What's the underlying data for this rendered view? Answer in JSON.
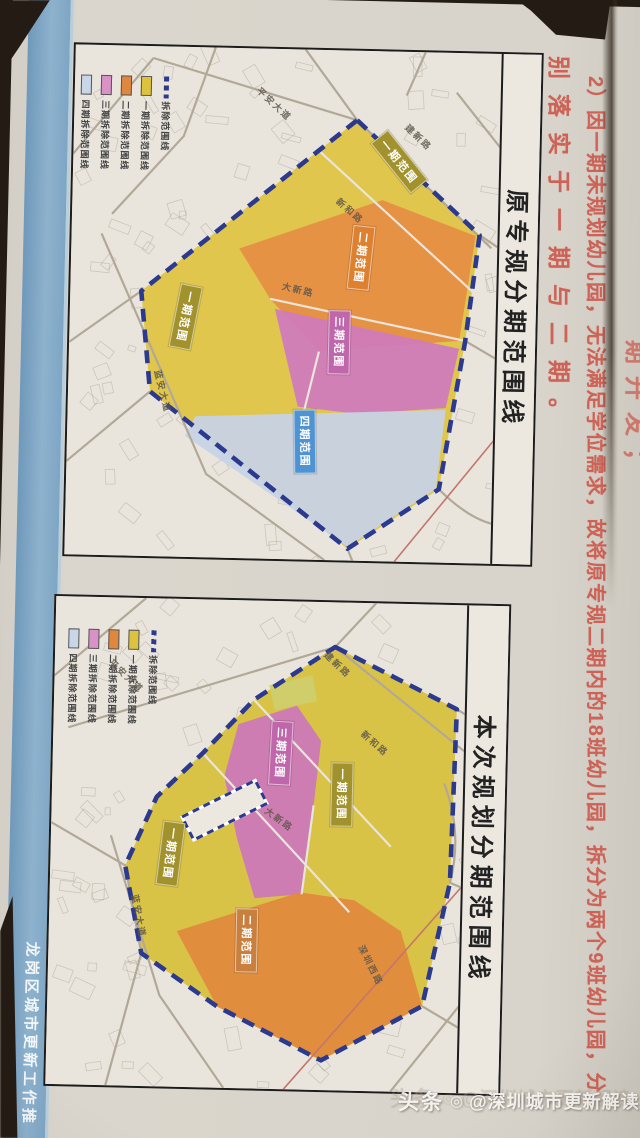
{
  "photo": {
    "table_color": "#241c14",
    "paper_color": "#d8d4cb"
  },
  "side_strip": {
    "color": "#84abc8",
    "label": "龙岗区城市更新工作推"
  },
  "annotations": {
    "color": "#cd5a4e",
    "partial_line": "期开发；",
    "line1": "2）因一期未规划幼儿园，无法满足学位需求，故将原专规二期内的18班幼儿园，拆分为两个9班幼儿园，分",
    "line2": "别落实于一期与二期。"
  },
  "watermark": {
    "brand": "头条",
    "logo_glyph": "◎",
    "handle": "@深圳城市更新解读"
  },
  "legend_items": [
    {
      "label": "四期拆除范围线",
      "color": "#c9d6e8",
      "kind": "swatch"
    },
    {
      "label": "三期拆除范围线",
      "color": "#d892c6",
      "kind": "swatch"
    },
    {
      "label": "二期拆除范围线",
      "color": "#e0873f",
      "kind": "swatch"
    },
    {
      "label": "一期拆除范围线",
      "color": "#ddc23f",
      "kind": "swatch"
    },
    {
      "label": "拆除范围线",
      "color": "#2b3a8e",
      "kind": "dash"
    }
  ],
  "maps": [
    {
      "title": "原专规分期范围线",
      "frame": {
        "left": 62,
        "top": 48,
        "width": 470,
        "height": 514,
        "band": 40
      },
      "legend_pos": {
        "x": 6,
        "y": 30
      },
      "outline": {
        "color": "#2b3a8e",
        "points": [
          [
            283,
            70
          ],
          [
            408,
            183
          ],
          [
            396,
            290
          ],
          [
            373,
            440
          ],
          [
            283,
            502
          ],
          [
            82,
            348
          ],
          [
            71,
            247
          ]
        ]
      },
      "regions": [
        {
          "name": "phase1-area",
          "color": "#e0c445",
          "points": [
            [
              283,
              70
            ],
            [
              408,
              183
            ],
            [
              396,
              290
            ],
            [
              373,
              440
            ],
            [
              283,
              502
            ],
            [
              82,
              348
            ],
            [
              71,
              247
            ]
          ]
        },
        {
          "name": "phase2-area",
          "color": "#e68f44",
          "points": [
            [
              168,
              202
            ],
            [
              310,
              150
            ],
            [
              404,
              184
            ],
            [
              390,
              290
            ],
            [
              250,
              304
            ],
            [
              200,
              252
            ]
          ]
        },
        {
          "name": "phase3-area",
          "color": "#d07cba",
          "points": [
            [
              205,
              262
            ],
            [
              390,
              298
            ],
            [
              378,
              358
            ],
            [
              290,
              366
            ],
            [
              230,
              360
            ]
          ]
        },
        {
          "name": "phase4-area",
          "color": "#c7d3e4",
          "points": [
            [
              128,
              372
            ],
            [
              378,
              360
            ],
            [
              370,
              440
            ],
            [
              283,
              500
            ],
            [
              118,
              392
            ]
          ]
        }
      ],
      "roads": [
        {
          "d": "M78,12 L283,70 L420,196"
        },
        {
          "d": "M0,110 L78,12"
        },
        {
          "d": "M140,0 L110,90 L40,170"
        },
        {
          "d": "M230,0 L283,70"
        },
        {
          "d": "M0,300 L71,247"
        },
        {
          "d": "M0,420 L82,348"
        },
        {
          "d": "M30,190 L140,430 L260,514"
        },
        {
          "d": "M247,103 L402,240",
          "light": true
        },
        {
          "d": "M200,252 L396,290",
          "light": true
        },
        {
          "d": "M250,304 L236,366",
          "light": true
        },
        {
          "d": "M373,440 Q402,468 428,474"
        },
        {
          "d": "M283,502 L288,514"
        },
        {
          "d": "M330,514 L428,388",
          "red": true
        },
        {
          "d": "M396,290 L428,308"
        },
        {
          "d": "M408,183 L428,196"
        },
        {
          "d": "M350,0 L332,44"
        },
        {
          "d": "M428,96 L382,40"
        }
      ],
      "badges": [
        {
          "label": "一期范围",
          "color": "#a2922e",
          "x": 326,
          "y": 110,
          "rot": 50
        },
        {
          "label": "二期范围",
          "color": "#dd8030",
          "x": 290,
          "y": 207,
          "rot": 95
        },
        {
          "label": "三期范围",
          "color": "#c066ab",
          "x": 270,
          "y": 292,
          "rot": 90
        },
        {
          "label": "一期范围",
          "color": "#a2922e",
          "x": 116,
          "y": 270,
          "rot": 100
        },
        {
          "label": "四期范围",
          "color": "#4f93d2",
          "x": 238,
          "y": 392,
          "rot": 88
        }
      ],
      "road_labels": [
        {
          "label": "平安大道",
          "x": 200,
          "y": 55,
          "rot": 42
        },
        {
          "label": "建新路",
          "x": 345,
          "y": 85,
          "rot": 42
        },
        {
          "label": "新和路",
          "x": 278,
          "y": 160,
          "rot": 40
        },
        {
          "label": "大新路",
          "x": 228,
          "y": 240,
          "rot": 12
        },
        {
          "label": "蓝安大道",
          "x": 95,
          "y": 345,
          "rot": 75
        }
      ]
    },
    {
      "title": "本次规划分期范围线",
      "frame": {
        "left": 55,
        "top": 600,
        "width": 457,
        "height": 492,
        "band": 42
      },
      "legend_pos": {
        "x": 13,
        "y": 32
      },
      "outline": {
        "color": "#2b3a8e",
        "points": [
          [
            280,
            45
          ],
          [
            403,
            105
          ],
          [
            400,
            280
          ],
          [
            375,
            405
          ],
          [
            275,
            462
          ],
          [
            170,
            410
          ],
          [
            93,
            358
          ],
          [
            75,
            270
          ],
          [
            105,
            200
          ],
          [
            150,
            155
          ],
          [
            200,
            100
          ]
        ]
      },
      "regions": [
        {
          "name": "phase1-area",
          "color": "#d8c13e",
          "points": [
            [
              280,
              45
            ],
            [
              403,
              105
            ],
            [
              400,
              280
            ],
            [
              375,
              405
            ],
            [
              275,
              462
            ],
            [
              170,
              410
            ],
            [
              93,
              358
            ],
            [
              75,
              270
            ],
            [
              105,
              200
            ],
            [
              150,
              155
            ],
            [
              200,
              100
            ]
          ]
        },
        {
          "name": "park-area",
          "color": "#cfcf6d",
          "points": [
            [
              215,
              85
            ],
            [
              258,
              74
            ],
            [
              263,
              100
            ],
            [
              221,
              110
            ]
          ]
        },
        {
          "name": "phase3-area",
          "color": "#cc79b7",
          "points": [
            [
              185,
              125
            ],
            [
              243,
              105
            ],
            [
              268,
              140
            ],
            [
              262,
              205
            ],
            [
              252,
              295
            ],
            [
              205,
              300
            ],
            [
              186,
              240
            ],
            [
              172,
              178
            ]
          ]
        },
        {
          "name": "phase2-area",
          "color": "#e28a3e",
          "points": [
            [
              128,
              335
            ],
            [
              250,
              293
            ],
            [
              305,
              300
            ],
            [
              352,
              330
            ],
            [
              375,
              405
            ],
            [
              275,
              462
            ],
            [
              170,
              410
            ]
          ]
        }
      ],
      "dashed_rect": {
        "x": 173,
        "y": 212,
        "w": 82,
        "h": 26,
        "rot": -28,
        "fill": "#ece8df",
        "stroke": "#2b3a8e"
      },
      "roads": [
        {
          "d": "M15,132 L280,45 L415,150"
        },
        {
          "d": "M0,80 L90,0"
        },
        {
          "d": "M320,0 L280,45"
        },
        {
          "d": "M0,228 L75,270 L93,358 L60,492"
        },
        {
          "d": "M60,240 L112,400 L178,492"
        },
        {
          "d": "M200,100 L340,245",
          "light": true
        },
        {
          "d": "M150,155 L300,312",
          "light": true
        },
        {
          "d": "M262,205 L252,295",
          "light": true
        },
        {
          "d": "M375,405 L415,428"
        },
        {
          "d": "M415,280 L238,492",
          "red": true
        },
        {
          "d": "M403,105 L415,112"
        },
        {
          "d": "M345,492 L415,400"
        },
        {
          "d": "M400,280 L415,286"
        },
        {
          "d": "M392,180 Q412,230 400,280"
        }
      ],
      "badges": [
        {
          "label": "三期范围",
          "color": "#c066ab",
          "x": 228,
          "y": 152,
          "rot": 92
        },
        {
          "label": "一期范围",
          "color": "#a2922e",
          "x": 290,
          "y": 192,
          "rot": 90
        },
        {
          "label": "一期范围",
          "color": "#a2922e",
          "x": 120,
          "y": 255,
          "rot": 96
        },
        {
          "label": "二期范围",
          "color": "#c9803f",
          "x": 198,
          "y": 340,
          "rot": 90
        }
      ],
      "road_labels": [
        {
          "label": "平安大道",
          "x": 72,
          "y": 78,
          "rot": 42
        },
        {
          "label": "建新路",
          "x": 283,
          "y": 62,
          "rot": 42
        },
        {
          "label": "新和路",
          "x": 322,
          "y": 140,
          "rot": 40
        },
        {
          "label": "大新路",
          "x": 228,
          "y": 218,
          "rot": 35
        },
        {
          "label": "蓝安大道",
          "x": 90,
          "y": 318,
          "rot": 78
        },
        {
          "label": "深圳西路",
          "x": 323,
          "y": 362,
          "rot": 62
        }
      ]
    }
  ]
}
